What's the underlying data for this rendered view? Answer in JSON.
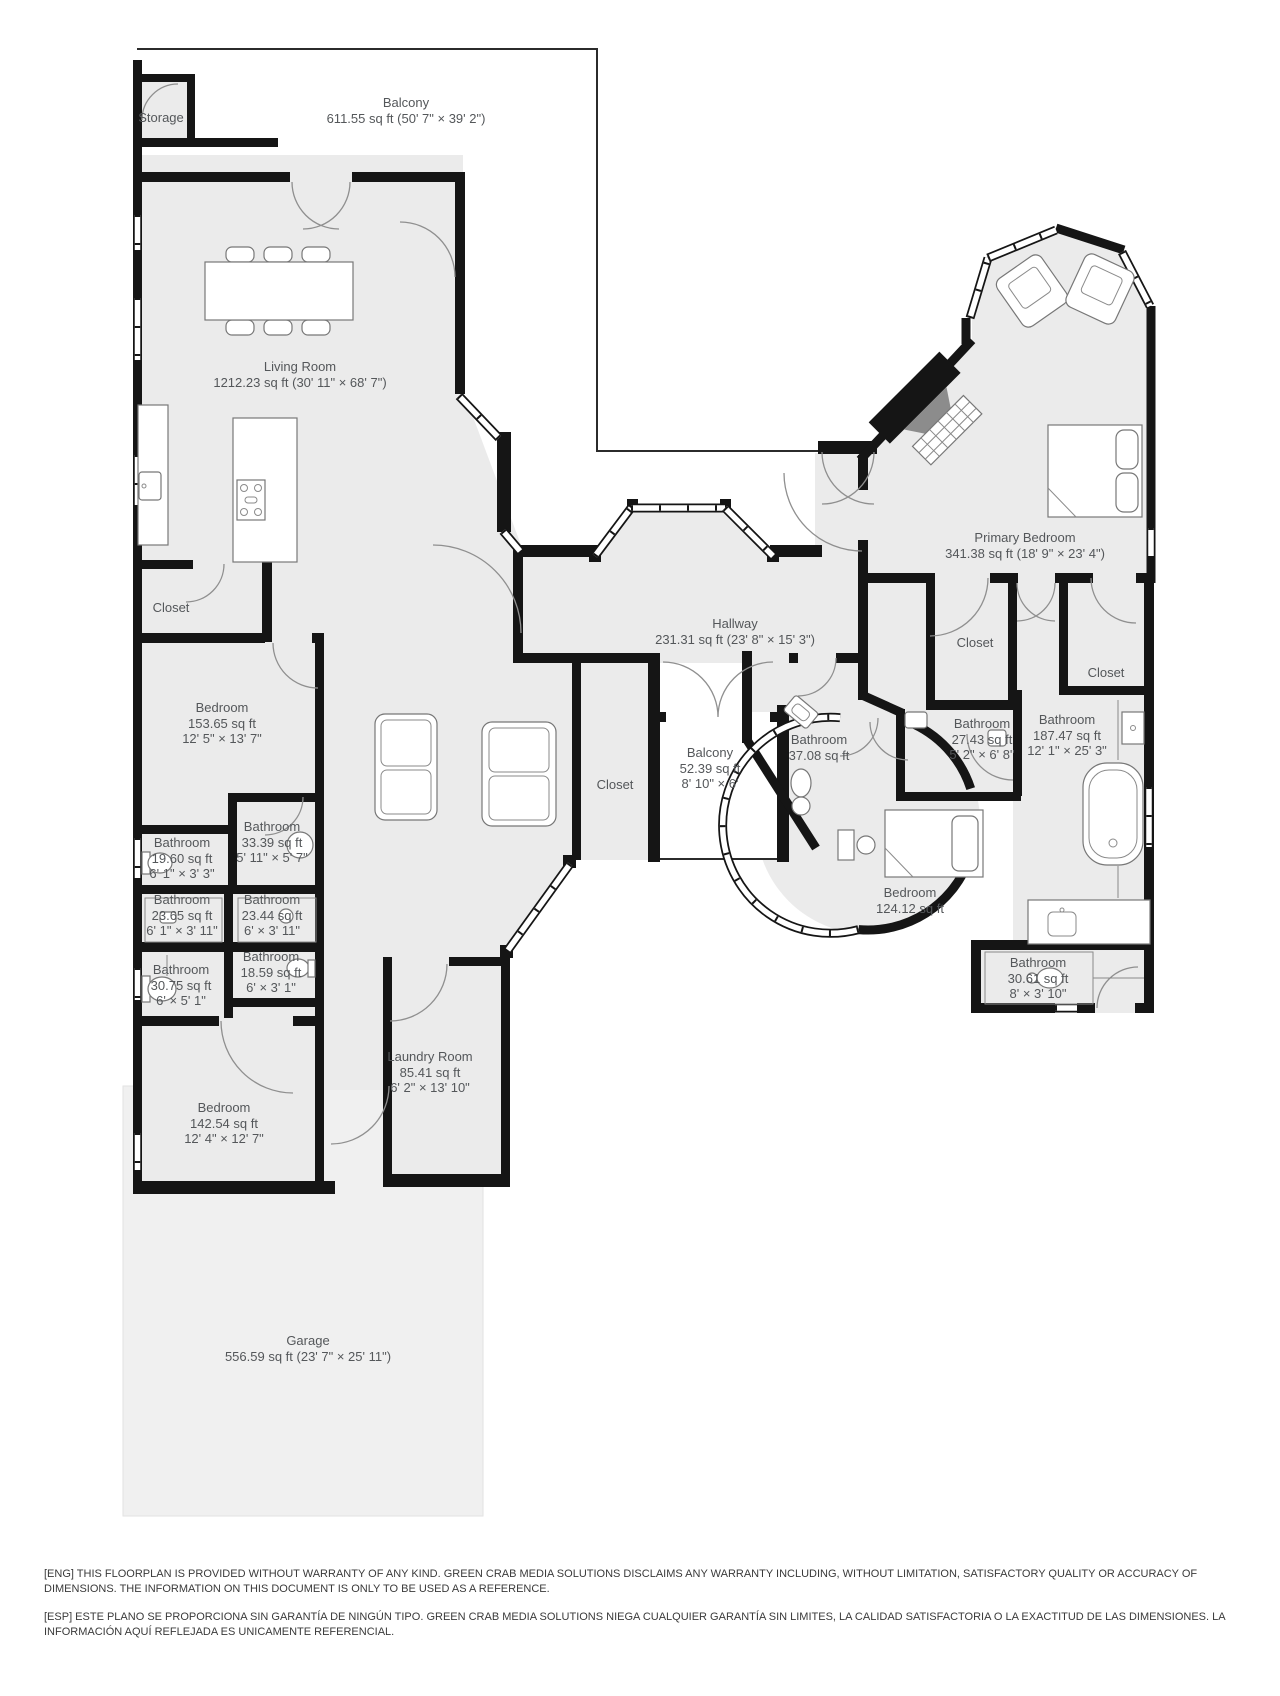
{
  "floorplan": {
    "rooms": {
      "storage": {
        "name": "Storage"
      },
      "balcony_top": {
        "name": "Balcony",
        "area_dims": "611.55 sq ft (50' 7\" × 39' 2\")"
      },
      "living_room": {
        "name": "Living Room",
        "area_dims": "1212.23 sq ft (30' 11\" × 68' 7\")"
      },
      "primary_bedroom": {
        "name": "Primary Bedroom",
        "area_dims": "341.38 sq ft (18' 9\" × 23' 4\")"
      },
      "hallway": {
        "name": "Hallway",
        "area_dims": "231.31 sq ft (23' 8\" × 15' 3\")"
      },
      "garage": {
        "name": "Garage",
        "area_dims": "556.59 sq ft (23' 7\" × 25' 11\")"
      },
      "closet_left": {
        "name": "Closet"
      },
      "closet_center": {
        "name": "Closet"
      },
      "closet_primary_a": {
        "name": "Closet"
      },
      "closet_primary_b": {
        "name": "Closet"
      },
      "bedroom_153": {
        "name": "Bedroom",
        "area": "153.65 sq ft",
        "dims": "12' 5\" × 13' 7\""
      },
      "balcony_center": {
        "name": "Balcony",
        "area": "52.39 sq ft",
        "dims": "8' 10\" × 6'"
      },
      "bathroom_3708": {
        "name": "Bathroom",
        "area": "37.08 sq ft"
      },
      "bathroom_2743": {
        "name": "Bathroom",
        "area": "27.43 sq ft",
        "dims": "5' 2\" × 6' 8\""
      },
      "bathroom_18747": {
        "name": "Bathroom",
        "area": "187.47 sq ft",
        "dims": "12' 1\" × 25' 3\""
      },
      "bathroom_1960": {
        "name": "Bathroom",
        "area": "19.60 sq ft",
        "dims": "6' 1\" × 3' 3\""
      },
      "bathroom_3339": {
        "name": "Bathroom",
        "area": "33.39 sq ft",
        "dims": "5' 11\" × 5' 7\""
      },
      "bathroom_2365": {
        "name": "Bathroom",
        "area": "23.65 sq ft",
        "dims": "6' 1\" × 3' 11\""
      },
      "bathroom_2344": {
        "name": "Bathroom",
        "area": "23.44 sq ft",
        "dims": "6' × 3' 11\""
      },
      "bathroom_3075": {
        "name": "Bathroom",
        "area": "30.75 sq ft",
        "dims": "6' × 5' 1\""
      },
      "bathroom_1859": {
        "name": "Bathroom",
        "area": "18.59 sq ft",
        "dims": "6' × 3' 1\""
      },
      "bedroom_124": {
        "name": "Bedroom",
        "area": "124.12 sq ft"
      },
      "bathroom_3061": {
        "name": "Bathroom",
        "area": "30.61 sq ft",
        "dims": "8' × 3' 10\""
      },
      "bedroom_142": {
        "name": "Bedroom",
        "area": "142.54 sq ft",
        "dims": "12' 4\" × 12' 7\""
      },
      "laundry": {
        "name": "Laundry Room",
        "area": "85.41 sq ft",
        "dims": "6' 2\" × 13' 10\""
      }
    },
    "disclaimer": {
      "eng": "[ENG] THIS FLOORPLAN IS PROVIDED WITHOUT WARRANTY OF ANY KIND. GREEN CRAB MEDIA SOLUTIONS DISCLAIMS ANY WARRANTY INCLUDING, WITHOUT LIMITATION, SATISFACTORY QUALITY OR ACCURACY OF DIMENSIONS. THE INFORMATION ON THIS DOCUMENT IS ONLY TO BE USED AS A REFERENCE.",
      "esp": "[ESP] ESTE PLANO SE PROPORCIONA SIN GARANTÍA DE NINGÚN TIPO. GREEN CRAB MEDIA SOLUTIONS NIEGA CUALQUIER GARANTÍA SIN LIMITES, LA CALIDAD SATISFACTORIA O LA EXACTITUD DE LAS DIMENSIONES. LA INFORMACIÓN AQUÍ REFLEJADA ES UNICAMENTE REFERENCIAL."
    },
    "colors": {
      "room_fill": "#ebebeb",
      "garage_fill": "#f0f0f0",
      "wall": "#151515",
      "label_text": "#54575a"
    }
  }
}
